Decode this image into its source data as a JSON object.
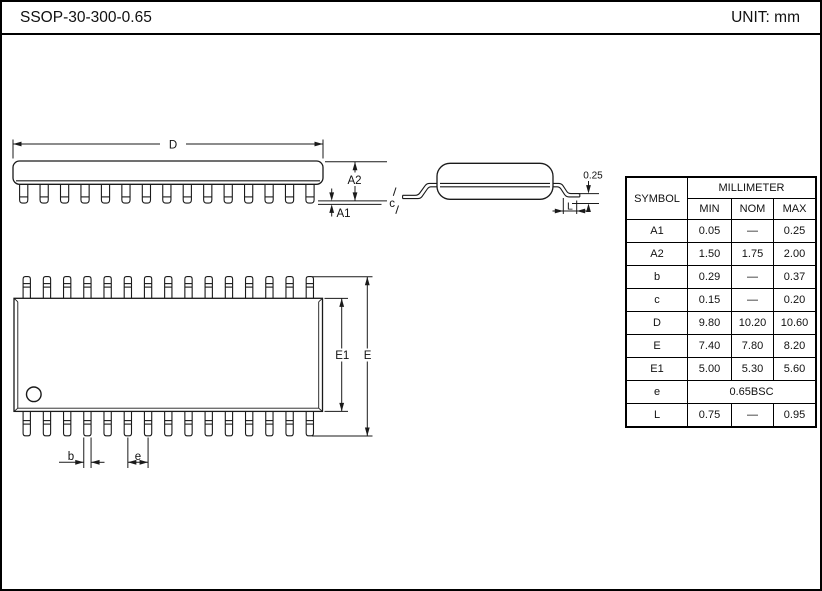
{
  "header": {
    "title": "SSOP-30-300-0.65",
    "unit": "UNIT: mm"
  },
  "drawing": {
    "side_view": {
      "dim_d": "D",
      "dim_a2": "A2",
      "dim_a1": "A1"
    },
    "end_view": {
      "dim_c": "c",
      "dim_offset": "0.25",
      "dim_l": "L"
    },
    "top_view": {
      "dim_e1": "E1",
      "dim_e": "E",
      "dim_b": "b",
      "dim_pitch": "e"
    }
  },
  "table": {
    "symbol_header": "SYMBOL",
    "unit_header": "MILLIMETER",
    "col_headers": [
      "MIN",
      "NOM",
      "MAX"
    ],
    "rows": [
      {
        "sym": "A1",
        "min": "0.05",
        "nom": "—",
        "max": "0.25"
      },
      {
        "sym": "A2",
        "min": "1.50",
        "nom": "1.75",
        "max": "2.00"
      },
      {
        "sym": "b",
        "min": "0.29",
        "nom": "—",
        "max": "0.37"
      },
      {
        "sym": "c",
        "min": "0.15",
        "nom": "—",
        "max": "0.20"
      },
      {
        "sym": "D",
        "min": "9.80",
        "nom": "10.20",
        "max": "10.60"
      },
      {
        "sym": "E",
        "min": "7.40",
        "nom": "7.80",
        "max": "8.20"
      },
      {
        "sym": "E1",
        "min": "5.00",
        "nom": "5.30",
        "max": "5.60"
      },
      {
        "sym": "e",
        "span": "0.65BSC"
      },
      {
        "sym": "L",
        "min": "0.75",
        "nom": "—",
        "max": "0.95"
      }
    ]
  },
  "colors": {
    "line": "#1a1a1a",
    "background": "#ffffff"
  }
}
